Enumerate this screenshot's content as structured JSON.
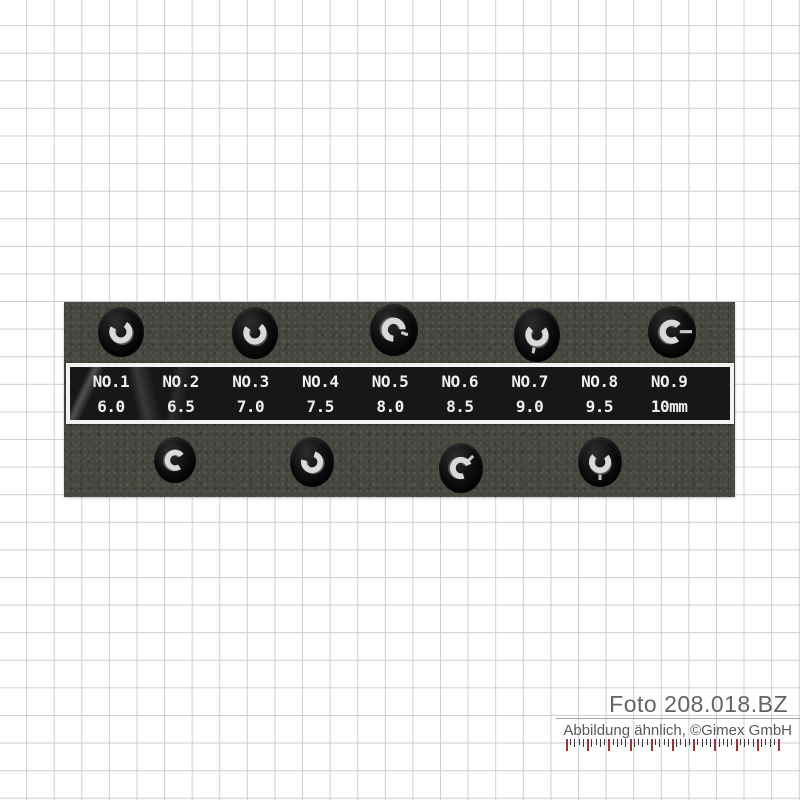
{
  "product_label": {
    "columns": [
      {
        "no": "NO.1",
        "size": "6.0"
      },
      {
        "no": "NO.2",
        "size": "6.5"
      },
      {
        "no": "NO.3",
        "size": "7.0"
      },
      {
        "no": "NO.4",
        "size": "7.5"
      },
      {
        "no": "NO.5",
        "size": "8.0"
      },
      {
        "no": "NO.6",
        "size": "8.5"
      },
      {
        "no": "NO.7",
        "size": "9.0"
      },
      {
        "no": "NO.8",
        "size": "9.5"
      },
      {
        "no": "NO.9",
        "size": "10mm"
      }
    ],
    "text_color": "#efefef",
    "bg_color": "#171717",
    "border_color": "#f2f2f2"
  },
  "watermark": {
    "photo_ref": "Foto 208.018.BZ",
    "disclaimer": "Abbildung ähnlich, ©Gimex GmbH",
    "text_color": "#636363"
  },
  "ruler": {
    "tick_count": 51,
    "major_every": 5,
    "major_tick_color": "#9e3438",
    "minor_tick_color": "#3a3a3a"
  },
  "scene": {
    "background": "grid-paper",
    "grid_line_color": "#cfcfcf",
    "foam_color": "#45483f",
    "hole_color": "#0a0a0a",
    "wrench_metal_color": "#d9d9d9",
    "wrench_count": 9,
    "wrenches_top_row": 5,
    "wrenches_bottom_row": 4
  }
}
